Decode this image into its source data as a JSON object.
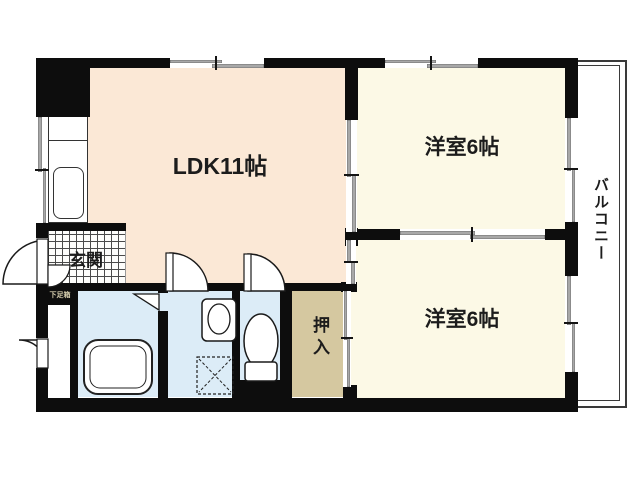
{
  "floorplan": {
    "rooms": {
      "ldk": {
        "label": "LDK11帖"
      },
      "bedroom_top": {
        "label": "洋室6帖"
      },
      "bedroom_bottom": {
        "label": "洋室6帖"
      },
      "balcony": {
        "label": "バルコニー"
      },
      "entrance": {
        "label": "玄関"
      },
      "closet": {
        "label": "押入"
      },
      "shoe_box": {
        "label": "下足箱"
      }
    },
    "colors": {
      "ldk_fill": "#fbe8d6",
      "bedroom_fill": "#fcf9e6",
      "wet_area_fill": "#dcecf7",
      "closet_fill": "#d5c8a0",
      "wall": "#0d0d0d",
      "window_gray": "#a8a8a8",
      "tile_line": "#4a4a4a"
    }
  }
}
